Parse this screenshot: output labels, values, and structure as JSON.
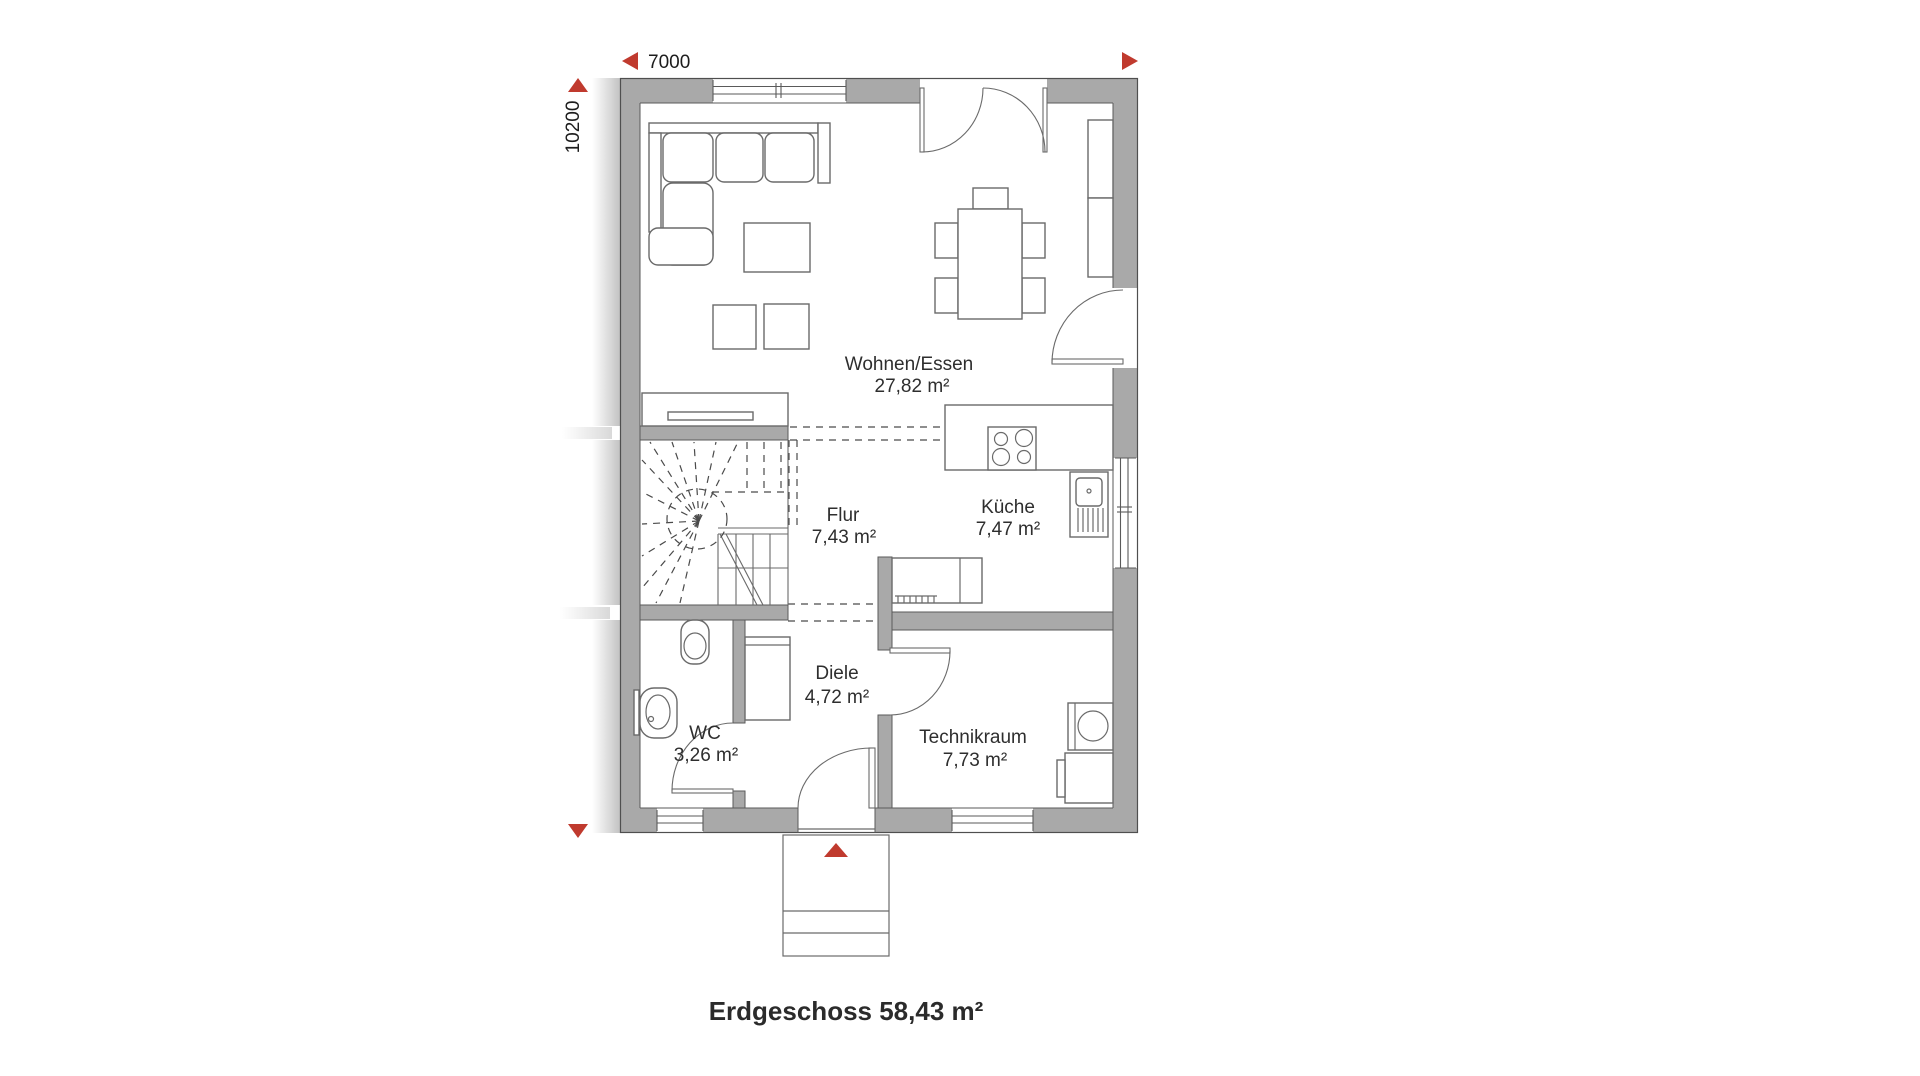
{
  "plan": {
    "title": "Erdgeschoss 58,43 m²",
    "dim_width": "7000",
    "dim_height": "10200",
    "rooms": [
      {
        "name": "Wohnen/Essen",
        "area": "27,82 m²"
      },
      {
        "name": "Flur",
        "area": "7,43 m²"
      },
      {
        "name": "Küche",
        "area": "7,47 m²"
      },
      {
        "name": "Diele",
        "area": "4,72 m²"
      },
      {
        "name": "WC",
        "area": "3,26 m²"
      },
      {
        "name": "Technikraum",
        "area": "7,73 m²"
      }
    ],
    "colors": {
      "wall_gray": "#a9a9a9",
      "accent_red": "#c03a2e",
      "line_dark": "#4f4f4f",
      "text": "#2e2e2e"
    }
  }
}
